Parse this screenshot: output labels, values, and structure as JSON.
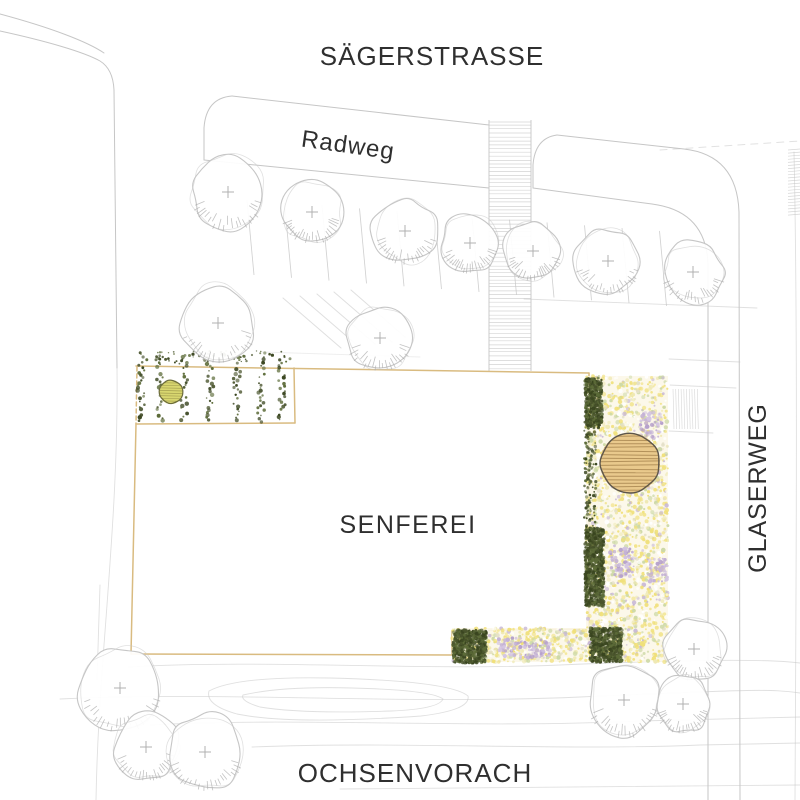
{
  "plan": {
    "title": "Site plan Senferei",
    "streets": {
      "top": "SÄGERSTRASSE",
      "bike_path": "Radweg",
      "right": "GLASERWEG",
      "bottom": "OCHSENVORACH"
    },
    "building": {
      "label": "SENFEREI"
    }
  },
  "colors": {
    "paper": "#ffffff",
    "pencil": "#c6c6c6",
    "pencil_dark": "#a9a9a9",
    "ink_text": "#2f2f2f",
    "site_outline": "#d9bb80",
    "bed_plant_darks": [
      "#49542c",
      "#5c6b38",
      "#39451f"
    ],
    "yellow_tree_fill": "#d8d66f",
    "yellow_tree_stroke": "#6c6c3d",
    "yellow_tree_hatch": "#9a9448",
    "canopy_fill": "#e9c98c",
    "canopy_hatch": "#a5834e",
    "canopy_stroke": "#5d564a",
    "strip_base": "#fbf7e6",
    "speckle_palette": [
      [
        "#f0e07a",
        42
      ],
      [
        "#efe9b4",
        14
      ],
      [
        "#cdd9a6",
        16
      ],
      [
        "#c6b6d6",
        7
      ],
      [
        "#ffffff",
        14
      ],
      [
        "#e4e0c8",
        7
      ]
    ],
    "lavender_shades": [
      "#c4b2d6",
      "#b5a0cb",
      "#d4c6e2"
    ]
  },
  "trees": {
    "pencil_trees": [
      {
        "x": 228,
        "y": 192,
        "r": 38
      },
      {
        "x": 312,
        "y": 212,
        "r": 31
      },
      {
        "x": 405,
        "y": 231,
        "r": 33
      },
      {
        "x": 470,
        "y": 243,
        "r": 30
      },
      {
        "x": 533,
        "y": 251,
        "r": 29
      },
      {
        "x": 608,
        "y": 261,
        "r": 33
      },
      {
        "x": 693,
        "y": 272,
        "r": 31
      },
      {
        "x": 218,
        "y": 323,
        "r": 39
      },
      {
        "x": 380,
        "y": 338,
        "r": 33
      },
      {
        "x": 120,
        "y": 688,
        "r": 43
      },
      {
        "x": 146,
        "y": 747,
        "r": 34
      },
      {
        "x": 205,
        "y": 752,
        "r": 39
      },
      {
        "x": 694,
        "y": 649,
        "r": 31
      },
      {
        "x": 624,
        "y": 700,
        "r": 37
      },
      {
        "x": 683,
        "y": 704,
        "r": 29
      }
    ],
    "yellow_tree": {
      "x": 171,
      "y": 392,
      "r": 12
    },
    "canopy_tree": {
      "x": 630,
      "y": 463,
      "r": 30
    }
  },
  "planting": {
    "bed": {
      "x": 137,
      "y": 366,
      "w": 158,
      "h": 58,
      "rows": [
        141,
        160,
        184,
        210,
        237,
        261,
        282
      ]
    },
    "right_strip": {
      "x": 586,
      "y": 376,
      "w": 82,
      "h": 286
    },
    "bottom_strip": {
      "x": 452,
      "y": 628,
      "w": 134,
      "h": 34
    },
    "dark_clusters": [
      [
        585,
        378,
        17,
        50
      ],
      [
        585,
        528,
        19,
        78
      ],
      [
        453,
        630,
        33,
        33
      ],
      [
        590,
        628,
        32,
        34
      ]
    ],
    "hedge_column": [
      584,
      420,
      12,
      115
    ],
    "lavender_patches": [
      [
        640,
        412,
        22,
        26
      ],
      [
        610,
        548,
        24,
        30
      ],
      [
        520,
        640,
        30,
        18
      ],
      [
        648,
        558,
        20,
        24
      ],
      [
        498,
        638,
        24,
        18
      ]
    ]
  }
}
